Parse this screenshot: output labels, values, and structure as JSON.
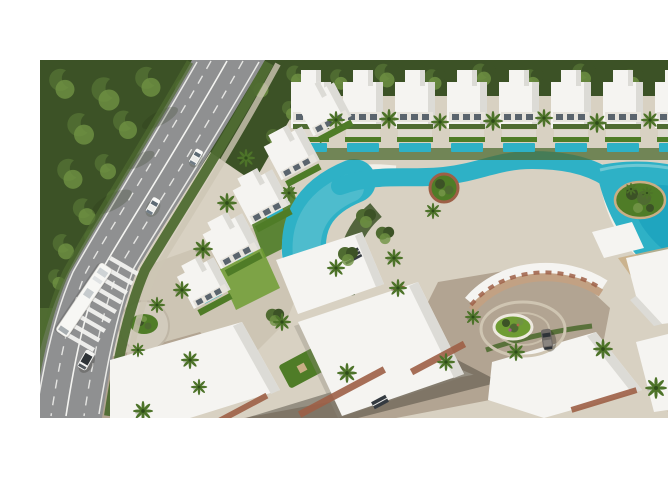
{
  "meta": {
    "type": "3d-architectural-aerial-render",
    "description": "Aerial 3D rendering of a modern resort-style residential compound: rows of white villas with rooftop gardens and private plunge pools, a winding turquoise lazy-river pool opening into a lagoon with a planted island, palm trees, a tree-lined highway with cars, a bus and a zebra crossing, and a cobblestone roundabout courtyard."
  },
  "canvas": {
    "width": 668,
    "height": 452,
    "photo_top": 44,
    "photo_height": 358,
    "letterbox_color": "#ffffff"
  },
  "palette": {
    "canopy_dark": "#3c5226",
    "canopy_mid": "#4f6b31",
    "canopy_light": "#6f9243",
    "lawn": "#6f9c33",
    "lawn_dark": "#4f7c27",
    "palm": "#4d7329",
    "palm_dark": "#2f4d1a",
    "road": "#8f9091",
    "marking": "#f4f4f1",
    "pavement": "#d8d1c2",
    "pebble": "#cdc5b4",
    "cobble": "#b2a492",
    "villa_white": "#f5f4f1",
    "villa_shade": "#dcdbd6",
    "terracotta": "#c2a183",
    "brick": "#9d5f46",
    "tan_deck": "#c9ae85",
    "pool": "#2eb1c6",
    "pool_deep": "#0f9ab8",
    "pool_light": "#8ad2da",
    "promenade": "#f2f0e9",
    "car_gray": "#6f6a66"
  },
  "scene": {
    "features": [
      "forest tree canopy",
      "divided highway with lane markings",
      "zebra crossing",
      "bus",
      "white cars",
      "parked white car",
      "gray car",
      "rows of white villas",
      "private plunge pools",
      "lazy river pool",
      "lagoon pool with planted island",
      "pool-side sun umbrellas",
      "palm trees",
      "rooftop lawns with sun decks",
      "cobblestone roundabout with landscaped island",
      "curved terracotta-trimmed building"
    ],
    "vehicles": {
      "white_cars": 3,
      "gray_cars": 1,
      "buses": 1
    }
  }
}
